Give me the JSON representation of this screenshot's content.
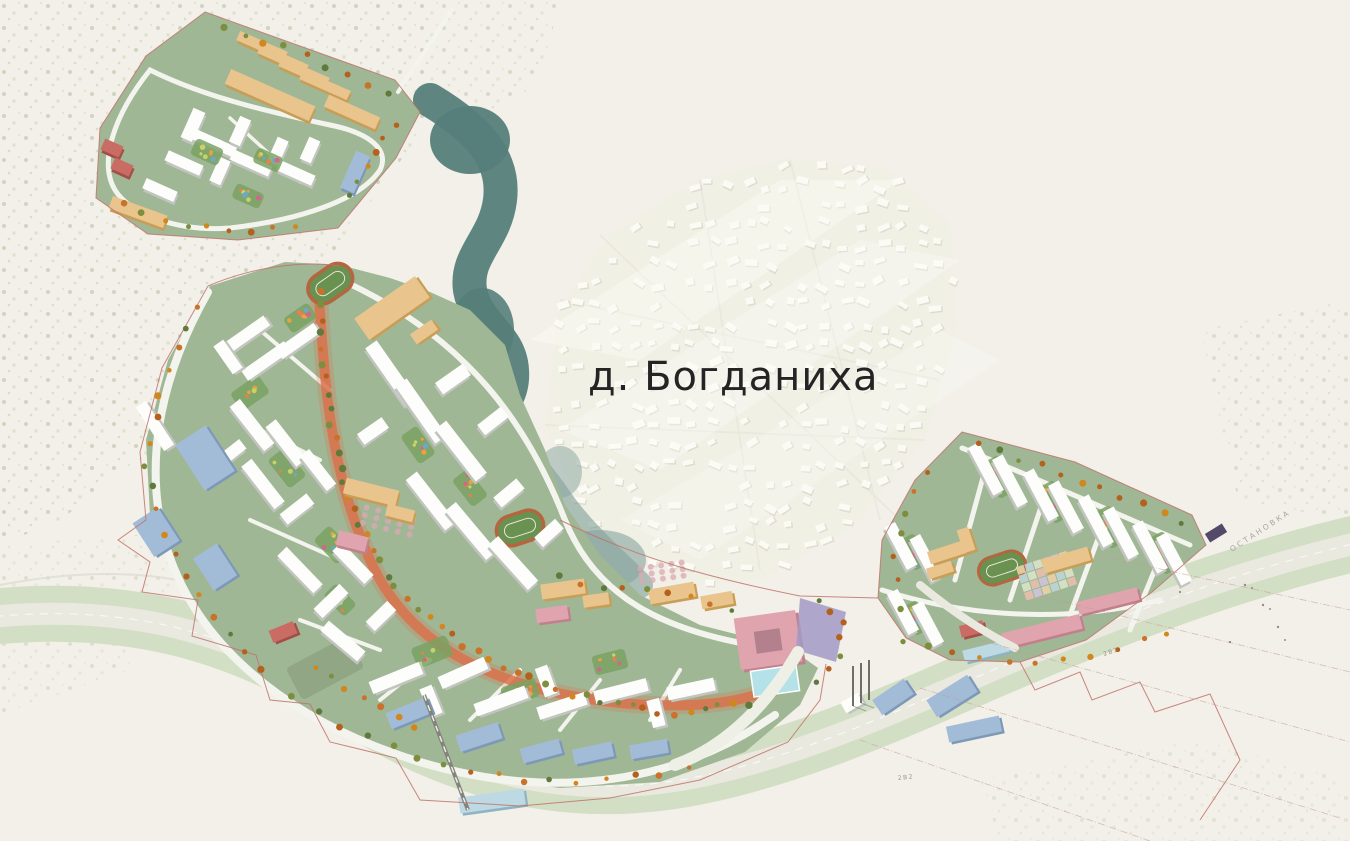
{
  "labels": {
    "village": "д. Богданиха",
    "road_marking": "ОСТАНОВКА",
    "utility_note": "2В2"
  },
  "colors": {
    "bg": "#f2f0e9",
    "forest_dot": "#c7cfb6",
    "forest_dot2": "#d8dec8",
    "pond_deep": "#567e7a",
    "pond_light": "#85a49d",
    "site_green": "#a0b795",
    "courtyard_green": "#7aa263",
    "lawn_green": "#8da383",
    "road": "#f4f4ee",
    "highway_verge": "#d3dfc4",
    "highway_asphalt": "#eae9e0",
    "building_white": "#fdfdfb",
    "building_white_side": "#c2c4bf",
    "building_beige": "#e9c48c",
    "building_beige_side": "#c89e57",
    "building_blue": "#a2bcd7",
    "building_blue_side": "#7d99b7",
    "building_pink": "#dfa4ae",
    "building_pink_side": "#c1808c",
    "building_cyan": "#bcd9e4",
    "building_cyan_side": "#8fb3c2",
    "building_red": "#c96c63",
    "building_red_side": "#a34f48",
    "boulevard": "#dc6f4a",
    "track_red": "#b5653f",
    "field_green": "#699150",
    "plaza_purple": "#a39ac6",
    "plaza_dot": "#dba8b4",
    "water_cyan": "#b5e2e8",
    "boundary_red": "#c0736b",
    "village_house": "#fcfbf6",
    "village_house_shadow": "#d6d4c5",
    "village_wash": "#f1efe4",
    "text_dark": "#242424",
    "text_faint": "#a6a399",
    "utility_line": "#c49a93",
    "rail_gray": "#84847e",
    "stop_purple": "#524a68",
    "tree1": "#b3611c",
    "tree2": "#d1861e",
    "tree3": "#c9722a",
    "tree4": "#7d8f3e",
    "tree5": "#5f7a3c",
    "dot1": "#e8a33d",
    "dot2": "#d2668c",
    "dot3": "#6fa8c4",
    "dot4": "#c9d268",
    "dot5": "#e87f4f",
    "checker1": "#ead1a8",
    "checker2": "#bcd6d8",
    "checker3": "#d9e3c8",
    "checker4": "#e8bfae",
    "checker5": "#cfc3dd"
  }
}
